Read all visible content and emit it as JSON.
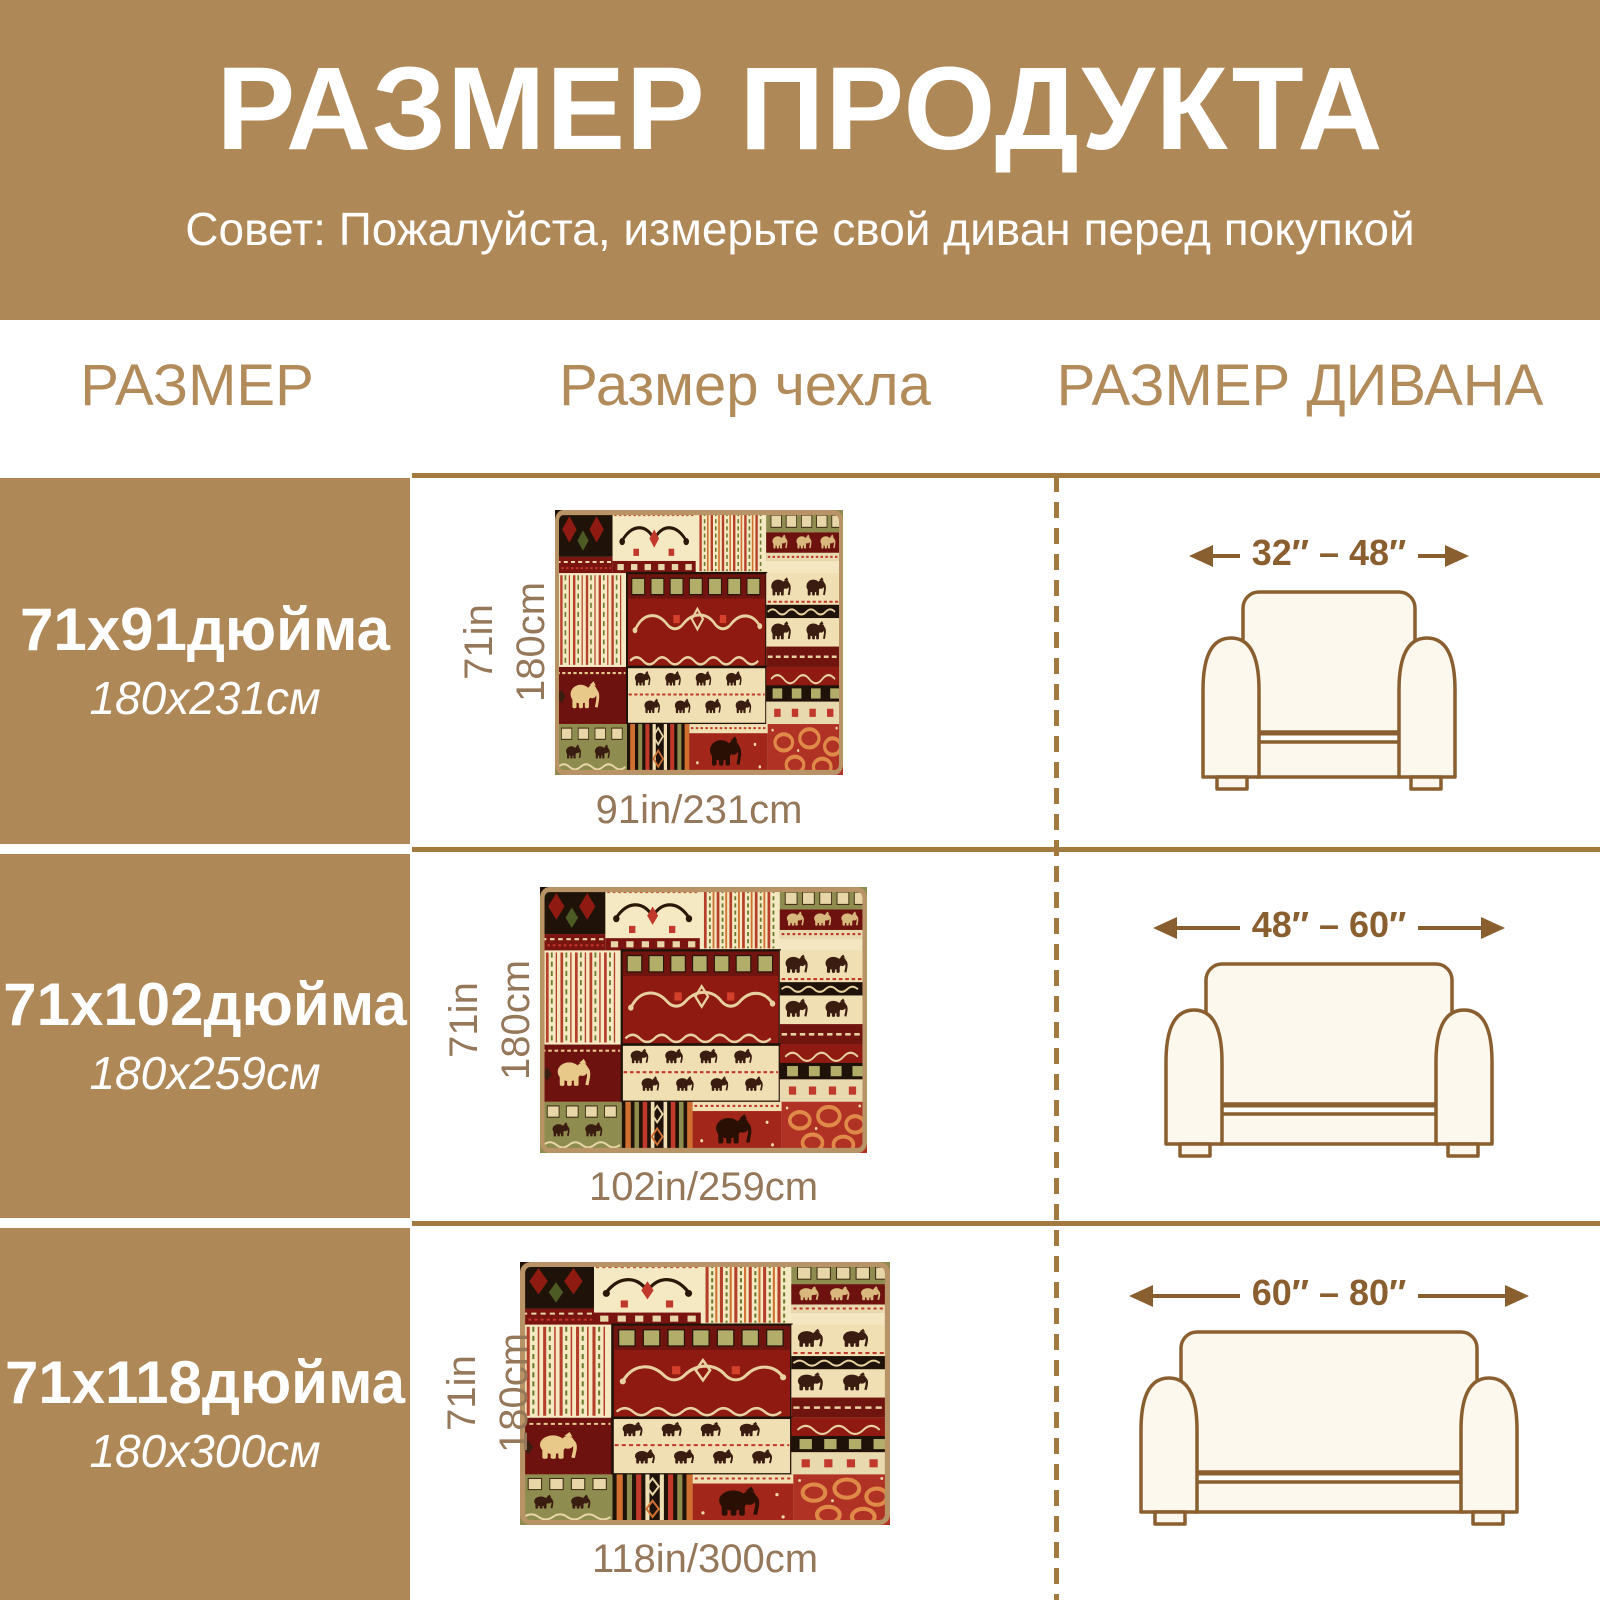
{
  "header": {
    "title": "РАЗМЕР ПРОДУКТА",
    "subtitle": "Совет: Пожалуйста, измерьте свой диван перед покупкой"
  },
  "columns": {
    "size": "РАЗМЕР",
    "cover": "Размер чехла",
    "sofa": "РАЗМЕР ДИВАНА"
  },
  "rows": [
    {
      "label_in": "71x91дюйма",
      "label_cm": "180x231см",
      "height_in": "71in",
      "height_cm": "180cm",
      "width_label": "91in/231cm",
      "sofa_range": "32″ – 48″",
      "sofa_type": "armchair"
    },
    {
      "label_in": "71x102дюйма",
      "label_cm": "180x259см",
      "height_in": "71in",
      "height_cm": "180cm",
      "width_label": "102in/259cm",
      "sofa_range": "48″ – 60″",
      "sofa_type": "loveseat"
    },
    {
      "label_in": "71x118дюйма",
      "label_cm": "180x300см",
      "height_in": "71in",
      "height_cm": "180cm",
      "width_label": "118in/300cm",
      "sofa_range": "60″ – 80″",
      "sofa_type": "three-seat-sofa"
    }
  ],
  "colors": {
    "tan_background": "#af8858",
    "header_text": "#ffffff",
    "column_header_text": "#b18b5a",
    "separator_brown": "#a2793f",
    "dimension_text": "#95785a",
    "arrow_brown": "#8a5f30",
    "sofa_fill": "#fcf8ee",
    "swatch_border": "#b79366",
    "fabric_palette": {
      "dark_red": "#8e1a12",
      "maroon": "#6e1210",
      "cream": "#f3e6c0",
      "olive": "#8f8c4f",
      "olive_square": "#b3ad6a",
      "black": "#1f1309",
      "orange": "#d07030",
      "accent_red": "#c0392b",
      "ring_orange": "#e08a4a"
    }
  }
}
